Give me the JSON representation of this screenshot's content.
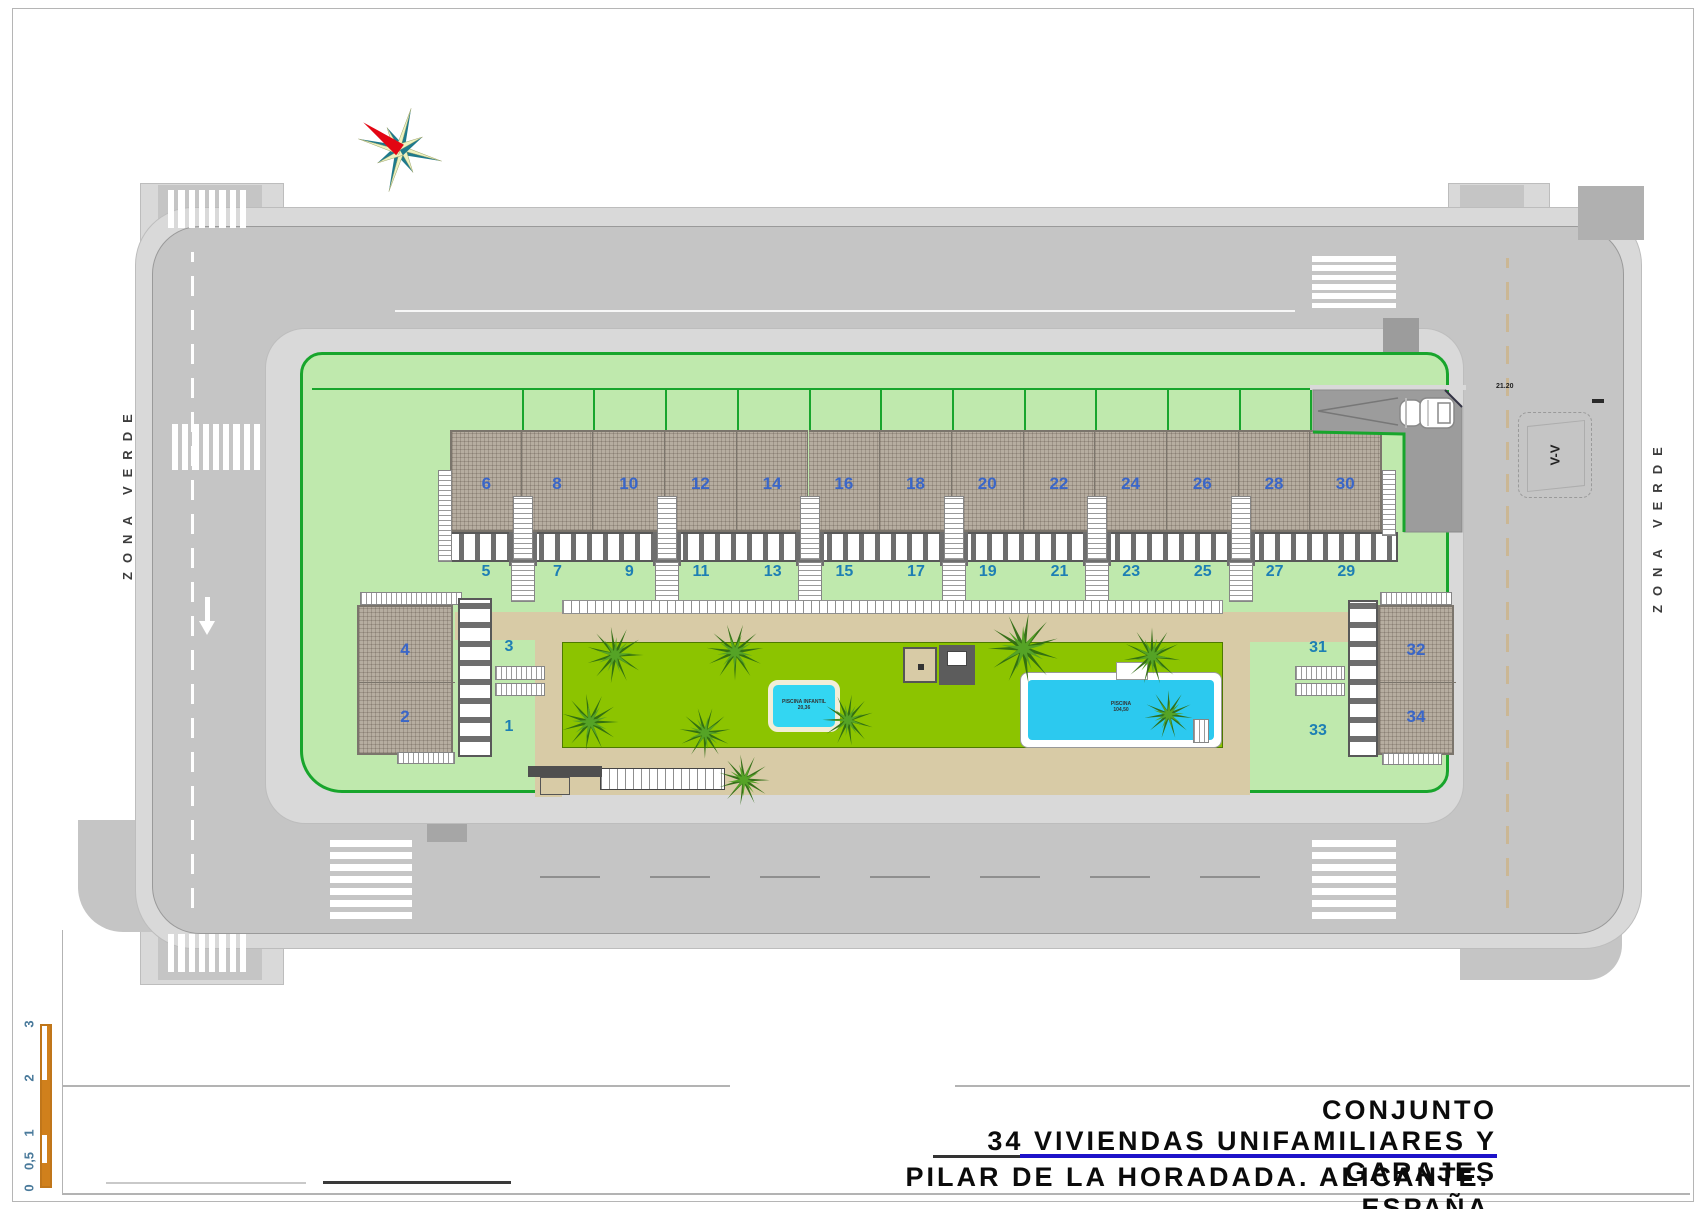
{
  "zona_verde_left": "ZONA VERDE",
  "zona_verde_right": "ZONA VERDE",
  "site": {
    "upper_unit_numbers": [
      "6",
      "8",
      "10",
      "12",
      "14",
      "16",
      "18",
      "20",
      "22",
      "24",
      "26",
      "28",
      "30"
    ],
    "lower_unit_numbers": [
      "5",
      "7",
      "9",
      "11",
      "13",
      "15",
      "17",
      "19",
      "21",
      "23",
      "25",
      "27",
      "29"
    ],
    "left_block": {
      "upper": "4",
      "lower": "2",
      "front_upper": "3",
      "front_lower": "1"
    },
    "right_block": {
      "upper": "32",
      "lower": "34",
      "front_upper": "31",
      "front_lower": "33"
    }
  },
  "pools": {
    "kids": {
      "label": "PISCINA INFANTIL",
      "area": "20,36"
    },
    "main": {
      "label": "PISCINA",
      "area": "104,50"
    }
  },
  "annotations": {
    "section_marker": "V-V",
    "dimension": "21.20"
  },
  "scale_bar": {
    "labels": [
      "3",
      "2",
      "1",
      "0,5",
      "0"
    ]
  },
  "title_block": {
    "line1": "CONJUNTO",
    "line2": "34 VIVIENDAS UNIFAMILIARES Y GARAJES",
    "line3": "PILAR DE LA HORADADA. ALICANTE. ESPAÑA"
  }
}
